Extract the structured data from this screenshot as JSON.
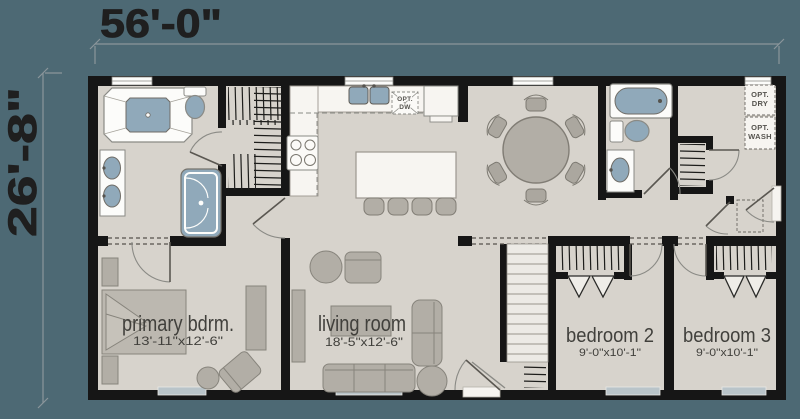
{
  "plan": {
    "overall": {
      "width_label": "56'-0\"",
      "depth_label": "26'-8\""
    },
    "rooms": {
      "primary_bedroom": {
        "name": "primary bdrm.",
        "size": "13'-11\"x12'-6\""
      },
      "living_room": {
        "name": "living room",
        "size": "18'-5\"x12'-6\""
      },
      "bedroom_2": {
        "name": "bedroom 2",
        "size": "9'-0\"x10'-1\""
      },
      "bedroom_3": {
        "name": "bedroom 3",
        "size": "9'-0\"x10'-1\""
      }
    },
    "options": {
      "dryer": [
        "OPT.",
        "DRY"
      ],
      "washer": [
        "OPT.",
        "WASH"
      ],
      "dishwasher": [
        "OPT.",
        "DW"
      ]
    },
    "colors": {
      "background": "#4d6974",
      "floor": "#d7d3cc",
      "wall": "#161616",
      "water_fixture": "#90a9ba",
      "furniture": "#b2aea6",
      "counter_white": "#f7f5f1"
    }
  }
}
